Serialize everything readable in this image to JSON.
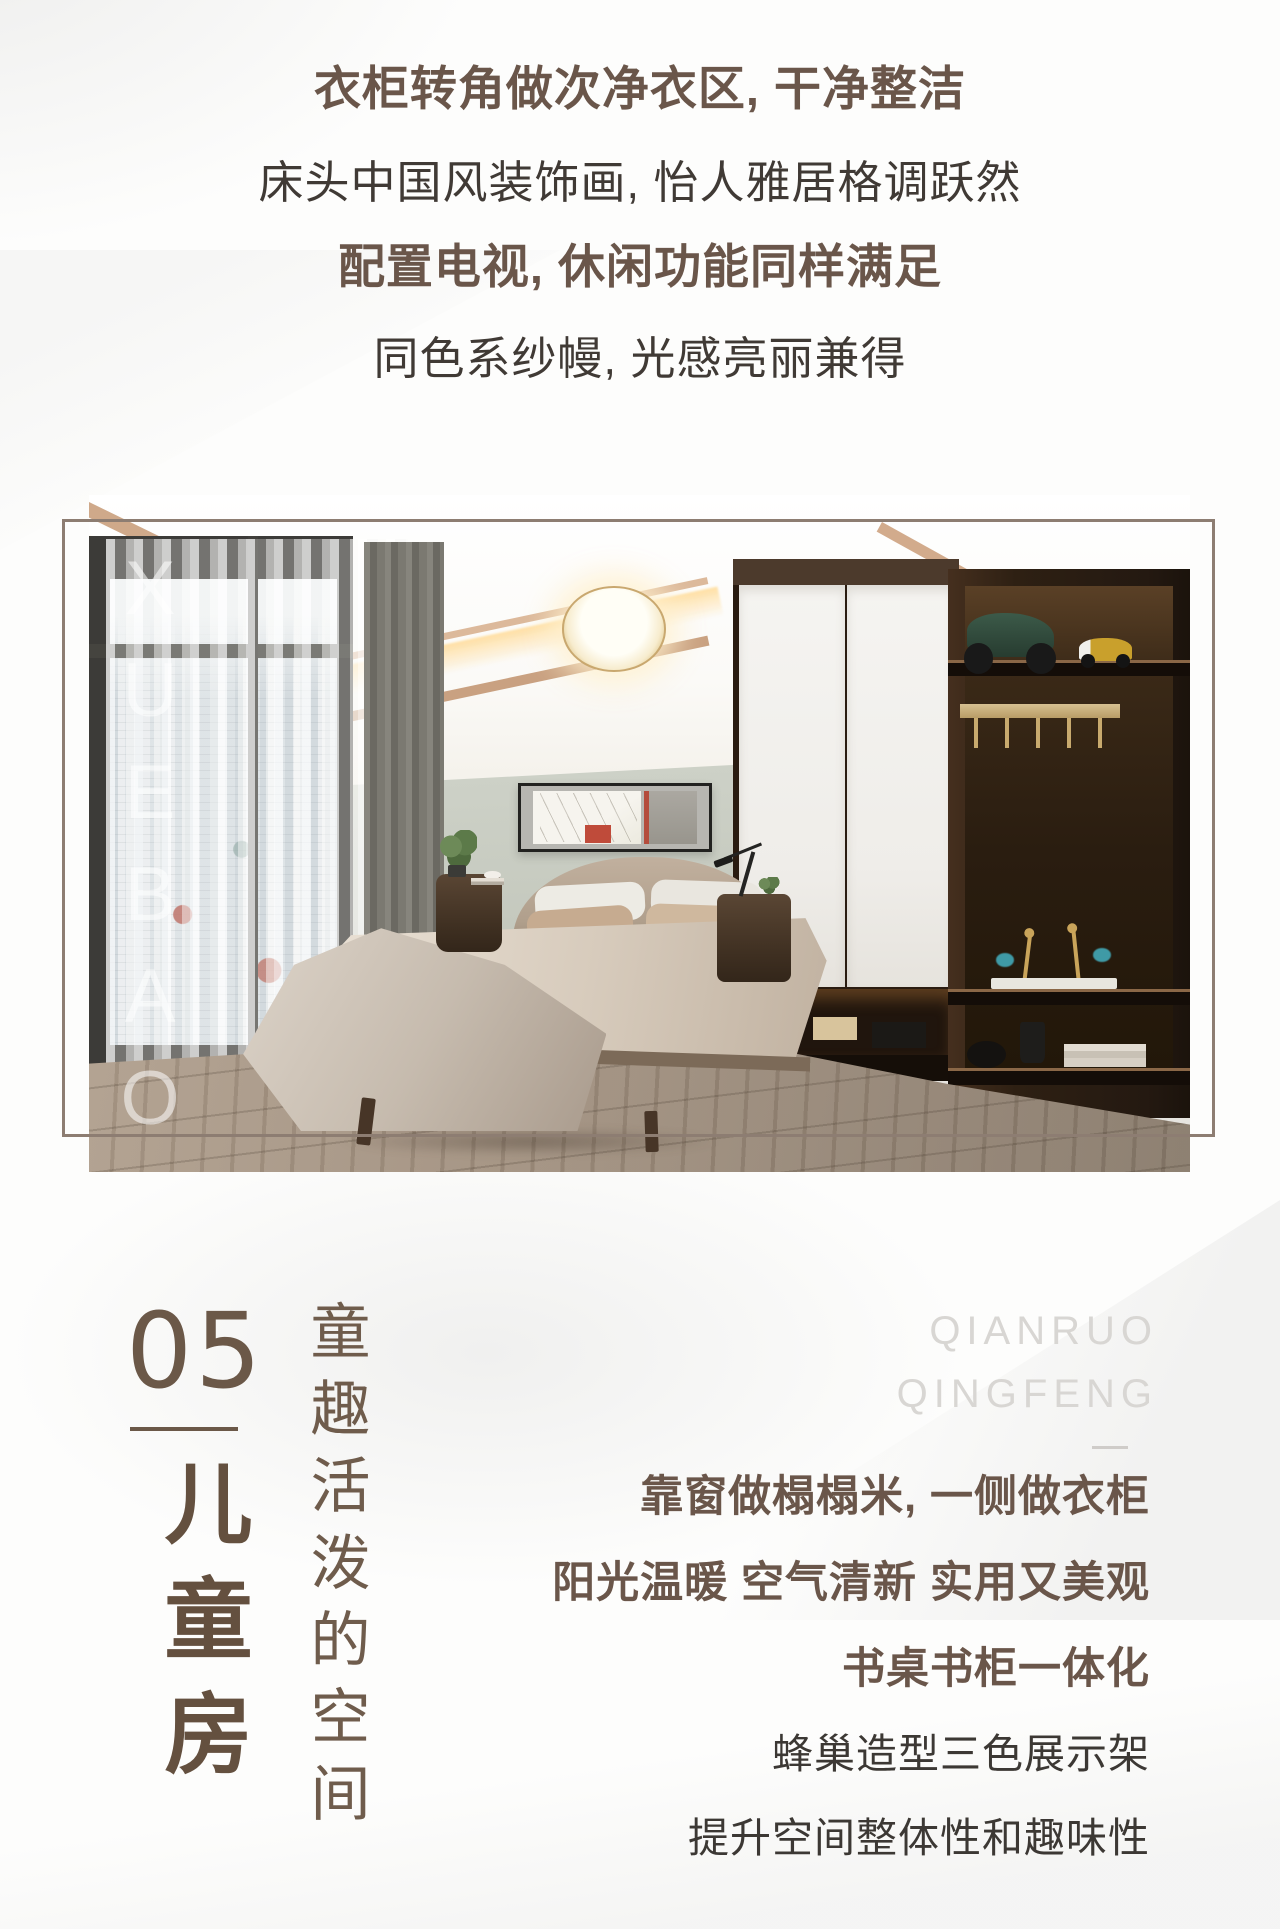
{
  "intro": {
    "lines": [
      {
        "text": "衣柜转角做次净衣区, 干净整洁",
        "style": "bold"
      },
      {
        "text": "床头中国风装饰画, 怡人雅居格调跃然",
        "style": "regular"
      },
      {
        "text": "配置电视, 休闲功能同样满足",
        "style": "bold"
      },
      {
        "text": "同色系纱幔, 光感亮丽兼得",
        "style": "regular"
      }
    ]
  },
  "photo": {
    "watermark": "XUEBAO"
  },
  "section": {
    "number": "05",
    "title_vertical": "儿童房",
    "subtitle_vertical": "童趣活泼的空间",
    "brand": {
      "line1": "QIANRUO",
      "line2": "QINGFENG"
    },
    "description": [
      {
        "text": "靠窗做榻榻米, 一侧做衣柜",
        "style": "bold"
      },
      {
        "text": "阳光温暖 空气清新 实用又美观",
        "style": "bold"
      },
      {
        "text": "书桌书柜一体化",
        "style": "bold"
      },
      {
        "text": "蜂巢造型三色展示架",
        "style": "regular"
      },
      {
        "text": "提升空间整体性和趣味性",
        "style": "regular"
      }
    ]
  },
  "colors": {
    "accent_brown": "#6b5848",
    "text_dark": "#3c3834",
    "frame_border": "#8d7d72",
    "brand_watermark_gray": "#d8d6d3",
    "photo_watermark": "rgba(255,255,255,0.55)",
    "wall_sage": "#c3c7bc",
    "wood_floor": "#a29180",
    "cabinet_wood": "#2e2013"
  }
}
